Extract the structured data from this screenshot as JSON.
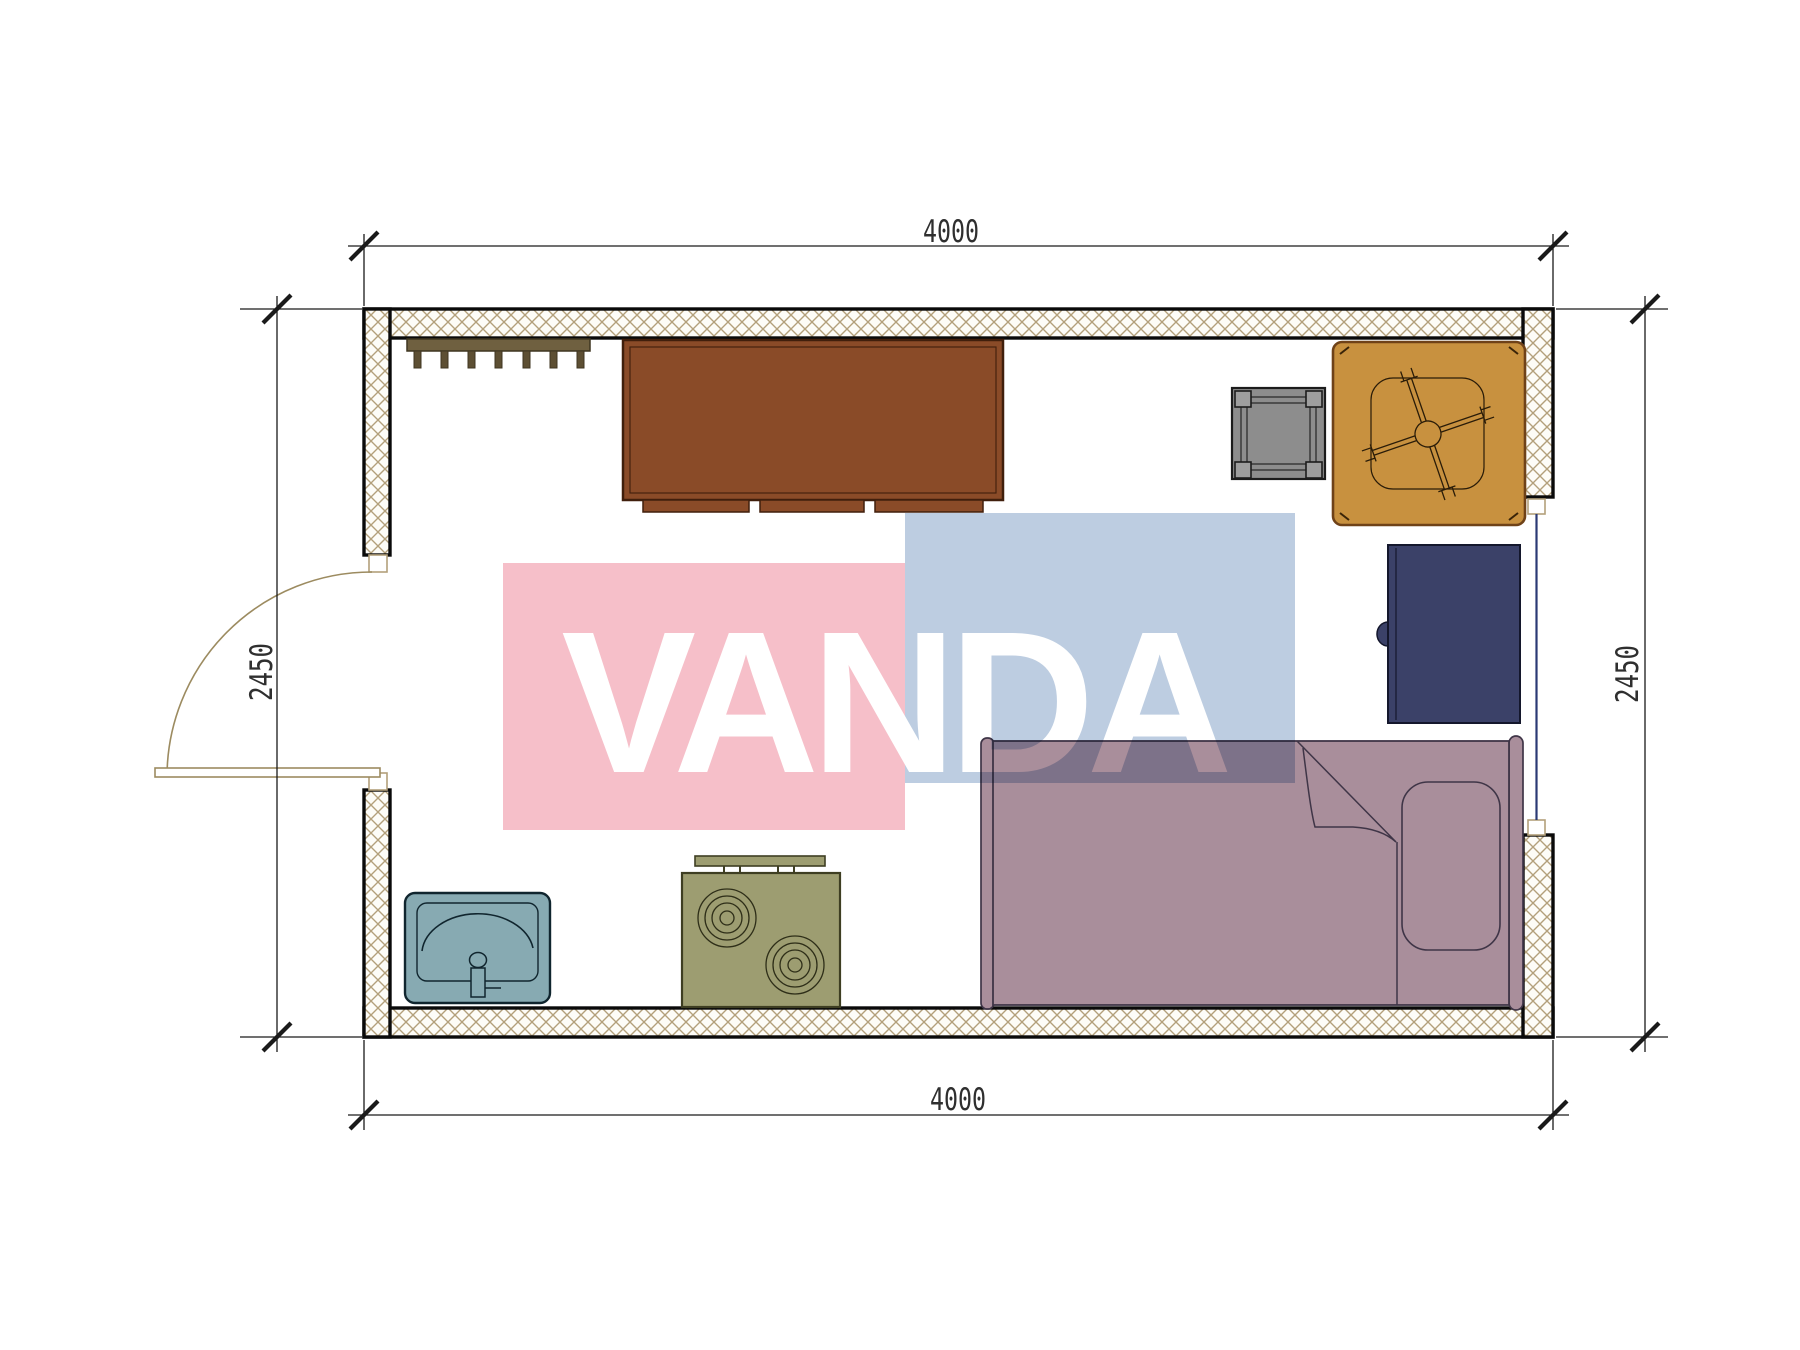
{
  "dimensions": {
    "top": "4000",
    "bottom": "4000",
    "left": "2450",
    "right": "2450"
  },
  "watermark": {
    "text": "VANDA",
    "pink_color": "#f6bfc9",
    "blue_color": "#bdcde1",
    "letter_color": "#ffffff"
  },
  "colors": {
    "wall_hatch_line": "#b3a07b",
    "wall_outline": "#0a0a0a",
    "wardrobe": "#8a4b28",
    "coat_rack": "#6f6040",
    "stool": "#8d8d8d",
    "fan_table": "#c8913f",
    "refrigerator": "#3b4168",
    "bed": "#a98e9b",
    "stove": "#9d9d71",
    "sink": "#87aab2",
    "door_swing": "#9c8b60",
    "window_glass": "#2b3a74",
    "dimension_line": "#1a1a1a"
  },
  "furniture": [
    {
      "name": "coat-rack"
    },
    {
      "name": "wardrobe"
    },
    {
      "name": "stool"
    },
    {
      "name": "table-with-ceiling-fan"
    },
    {
      "name": "refrigerator"
    },
    {
      "name": "single-bed"
    },
    {
      "name": "stove"
    },
    {
      "name": "sink"
    }
  ]
}
